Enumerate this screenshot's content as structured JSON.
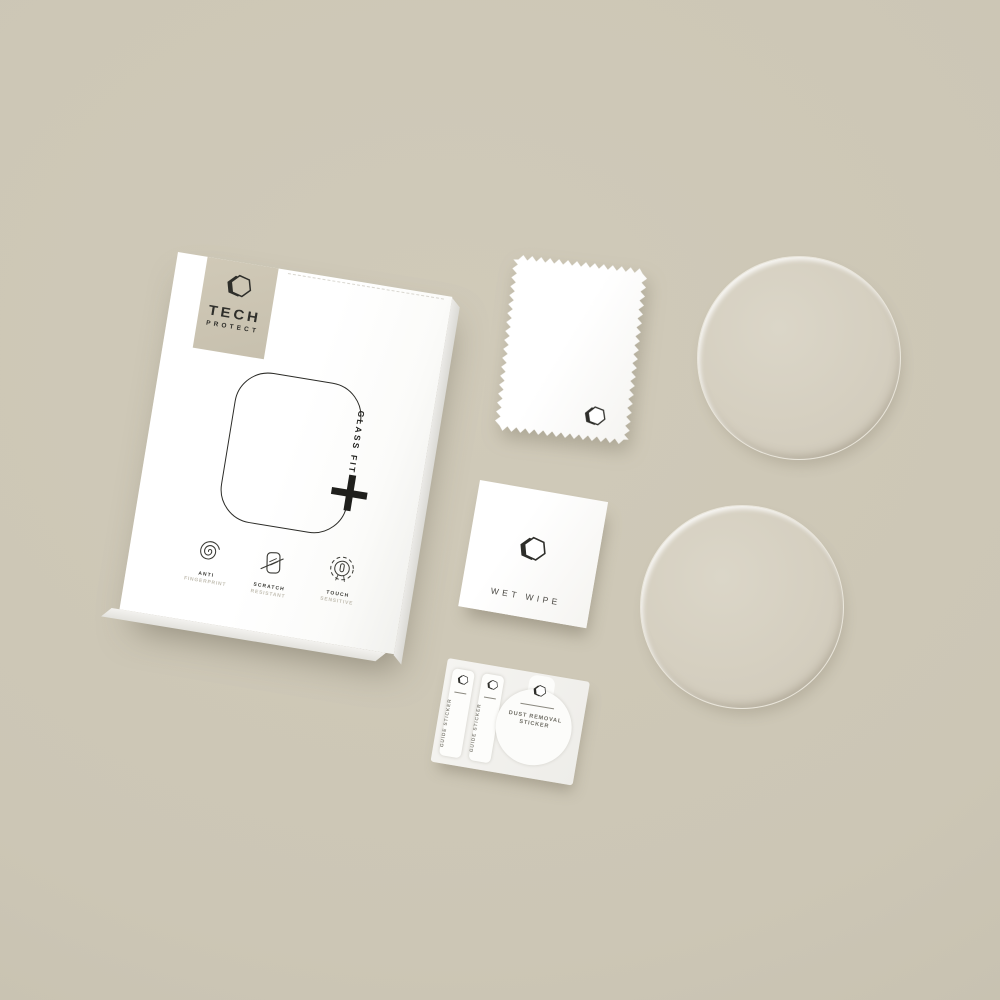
{
  "scene": {
    "description": "Tech Protect Glass Fit smartwatch screen protector kit flat lay",
    "background_color": "#ccc6b5"
  },
  "box": {
    "logo": {
      "brand_top": "TECH",
      "brand_bottom": "PROTECT"
    },
    "glass_fit_label": "GLASS FIT",
    "features": [
      {
        "title": "ANTI",
        "subtitle": "FINGERPRINT"
      },
      {
        "title": "SCRATCH",
        "subtitle": "RESISTANT"
      },
      {
        "title": "TOUCH",
        "subtitle": "SENSITIVE"
      }
    ]
  },
  "wet_wipe": {
    "label": "WET WIPE"
  },
  "sticker_card": {
    "guide_sticker_1": "GUIDE STICKER",
    "guide_sticker_2": "GUIDE STICKER",
    "dust_removal_line1": "DUST REMOVAL",
    "dust_removal_line2": "STICKER"
  },
  "colors": {
    "background": "#ccc6b5",
    "ink": "#2e2e2a",
    "badge": "#ccc5b3",
    "disc": "#d5cfc0"
  }
}
